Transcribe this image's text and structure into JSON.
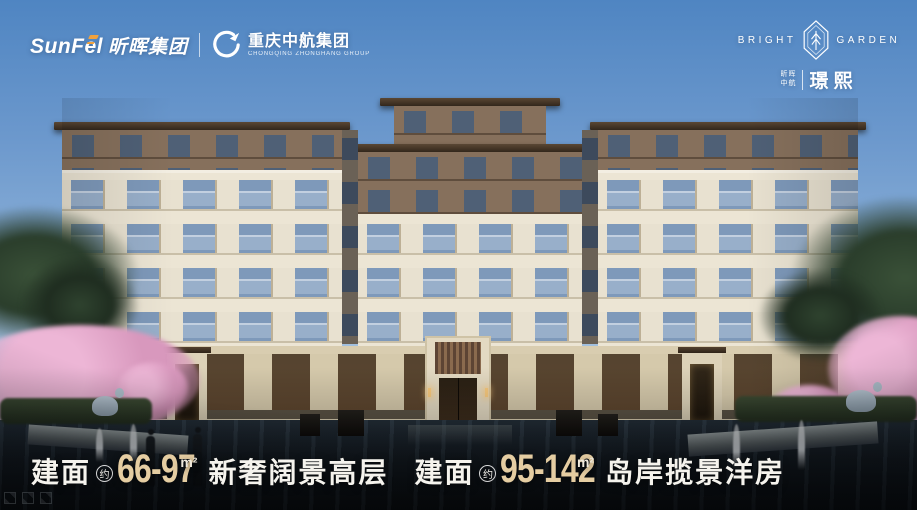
{
  "header": {
    "sunfel_logo": {
      "latin": "SunFel",
      "cn": "昕晖集团"
    },
    "partner_logo": {
      "cn": "重庆中航集团",
      "en": "CHONGQING ZHONGHANG GROUP"
    },
    "project_logo": {
      "en_left": "BRIGHT",
      "en_right": "GARDEN",
      "brand_top": "昕晖",
      "brand_bottom": "中航",
      "name": "璟熙"
    }
  },
  "tagline": {
    "groups": [
      {
        "prefix": "建面",
        "approx": "约",
        "range": "66-97",
        "unit": "m²",
        "desc": "新奢阔景高层"
      },
      {
        "prefix": "建面",
        "approx": "约",
        "range": "95-142",
        "unit": "m²",
        "desc": "岛岸揽景洋房"
      }
    ]
  },
  "colors": {
    "accent_gold": "#e5cda2",
    "accent_orange": "#f2a23c",
    "sky_top": "#4f85c2",
    "sky_bottom": "#cddced",
    "text_white": "#f5f3ed"
  }
}
